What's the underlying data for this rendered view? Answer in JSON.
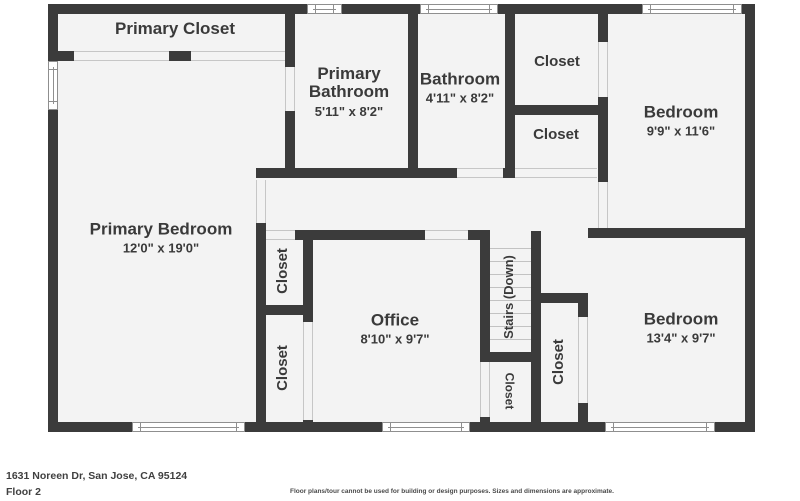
{
  "rooms": {
    "primary_closet": {
      "name": "Primary Closet"
    },
    "primary_bathroom": {
      "name": "Primary Bathroom",
      "dims": "5'11\" x 8'2\""
    },
    "bathroom": {
      "name": "Bathroom",
      "dims": "4'11\" x 8'2\""
    },
    "closet_top": {
      "name": "Closet"
    },
    "closet_hall": {
      "name": "Closet"
    },
    "bedroom_top": {
      "name": "Bedroom",
      "dims": "9'9\" x 11'6\""
    },
    "primary_bedroom": {
      "name": "Primary Bedroom",
      "dims": "12'0\" x 19'0\""
    },
    "closet_left_top": {
      "name": "Closet"
    },
    "closet_office": {
      "name": "Closet"
    },
    "office": {
      "name": "Office",
      "dims": "8'10\" x 9'7\""
    },
    "stairs": {
      "name": "Stairs (Down)"
    },
    "closet_under_stairs": {
      "name": "Closet"
    },
    "closet_bedroom2": {
      "name": "Closet"
    },
    "bedroom_bottom": {
      "name": "Bedroom",
      "dims": "13'4\" x 9'7\""
    }
  },
  "footer": {
    "address": "1631 Noreen Dr, San Jose, CA 95124",
    "floor": "Floor 2",
    "disclaimer": "Floor plans/tour cannot be used for building or design purposes. Sizes and dimensions are approximate."
  },
  "colors": {
    "wall": "#3b3b3b",
    "room_fill": "#f3f3f3",
    "text": "#3a3a3a",
    "background": "#ffffff"
  }
}
